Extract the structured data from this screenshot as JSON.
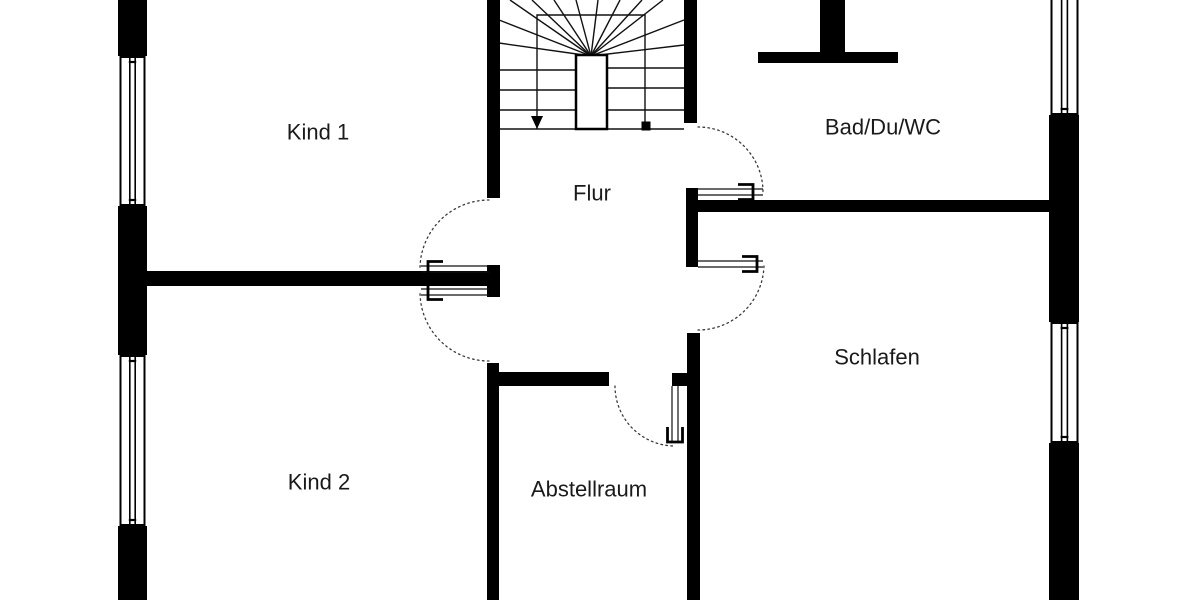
{
  "canvas": {
    "width": 1200,
    "height": 600,
    "background": "#ffffff",
    "wall_color": "#000000",
    "line_color": "#111111",
    "arc_color": "#3a3a3a",
    "label_color": "#1a1a1a",
    "label_font_size": 22
  },
  "rooms": [
    {
      "id": "kind1",
      "label": "Kind 1",
      "cx": 318,
      "cy": 132
    },
    {
      "id": "kind2",
      "label": "Kind 2",
      "cx": 319,
      "cy": 482
    },
    {
      "id": "flur",
      "label": "Flur",
      "cx": 592,
      "cy": 193
    },
    {
      "id": "bad",
      "label": "Bad/Du/WC",
      "cx": 883,
      "cy": 127
    },
    {
      "id": "schlafen",
      "label": "Schlafen",
      "cx": 877,
      "cy": 357
    },
    {
      "id": "abstellraum",
      "label": "Abstellraum",
      "cx": 589,
      "cy": 489
    }
  ],
  "walls": [
    {
      "id": "exterior-left-top",
      "x": 118,
      "y": 0,
      "w": 29,
      "h": 56
    },
    {
      "id": "exterior-left-mid",
      "x": 118,
      "y": 206,
      "w": 29,
      "h": 149
    },
    {
      "id": "exterior-left-bottom",
      "x": 118,
      "y": 526,
      "w": 29,
      "h": 74
    },
    {
      "id": "exterior-right-upper",
      "x": 1049,
      "y": 115,
      "w": 30,
      "h": 207
    },
    {
      "id": "exterior-right-lower",
      "x": 1049,
      "y": 443,
      "w": 30,
      "h": 157
    },
    {
      "id": "stair-left",
      "x": 487,
      "y": 0,
      "w": 13,
      "h": 198
    },
    {
      "id": "stair-right",
      "x": 684,
      "y": 0,
      "w": 13,
      "h": 123
    },
    {
      "id": "bad-south",
      "x": 697,
      "y": 200,
      "w": 352,
      "h": 12
    },
    {
      "id": "flur-east-stub",
      "x": 686,
      "y": 188,
      "w": 12,
      "h": 79
    },
    {
      "id": "schlafen-west",
      "x": 687,
      "y": 333,
      "w": 13,
      "h": 267
    },
    {
      "id": "kind-divider",
      "x": 147,
      "y": 271,
      "w": 340,
      "h": 15
    },
    {
      "id": "kind-door-stub",
      "x": 487,
      "y": 265,
      "w": 13,
      "h": 32
    },
    {
      "id": "abstellraum-west",
      "x": 487,
      "y": 363,
      "w": 12,
      "h": 237
    },
    {
      "id": "abstellraum-north",
      "x": 490,
      "y": 372,
      "w": 119,
      "h": 14
    },
    {
      "id": "abstellraum-north-stub",
      "x": 672,
      "y": 373,
      "w": 28,
      "h": 13
    },
    {
      "id": "chimney-block",
      "x": 820,
      "y": 0,
      "w": 25,
      "h": 63
    },
    {
      "id": "chimney-flange",
      "x": 758,
      "y": 52,
      "w": 140,
      "h": 11
    }
  ],
  "windows": [
    {
      "id": "kind1-west",
      "x": 119,
      "y": 56,
      "w": 27,
      "h": 150
    },
    {
      "id": "kind2-west",
      "x": 119,
      "y": 355,
      "w": 27,
      "h": 171
    },
    {
      "id": "bad-east",
      "x": 1050,
      "y": 0,
      "w": 29,
      "h": 115
    },
    {
      "id": "schlafen-east",
      "x": 1050,
      "y": 322,
      "w": 29,
      "h": 121
    }
  ],
  "doors": [
    {
      "id": "door-kind1",
      "hinge": [
        489,
        269
      ],
      "open": [
        -1,
        0
      ],
      "closed": [
        0,
        -1
      ],
      "r": 69,
      "leaf": 68,
      "bracket": [
        46,
        61
      ]
    },
    {
      "id": "door-kind2",
      "hinge": [
        489,
        292
      ],
      "open": [
        -1,
        0
      ],
      "closed": [
        0,
        1
      ],
      "r": 69,
      "leaf": 68,
      "bracket": [
        46,
        61
      ]
    },
    {
      "id": "door-bad",
      "hinge": [
        698,
        192
      ],
      "open": [
        1,
        0
      ],
      "closed": [
        0,
        -1
      ],
      "r": 65,
      "leaf": 65,
      "bracket": [
        40,
        55
      ]
    },
    {
      "id": "door-schlafen",
      "hinge": [
        698,
        264
      ],
      "open": [
        1,
        0
      ],
      "closed": [
        0,
        1
      ],
      "r": 66,
      "leaf": 65,
      "bracket": [
        44,
        59
      ]
    },
    {
      "id": "door-abstellraum",
      "hinge": [
        675,
        386
      ],
      "open": [
        0,
        1
      ],
      "closed": [
        -1,
        0
      ],
      "r": 60,
      "leaf": 57,
      "bracket": [
        41,
        56
      ]
    }
  ],
  "stair": {
    "x1": 499,
    "x2": 684,
    "y_bottom": 129,
    "inner": {
      "x1": 537,
      "x2": 645,
      "y1": 15
    },
    "newel": {
      "x": 576,
      "y": 55,
      "w": 31,
      "h": 74
    },
    "fan_center": [
      591,
      56
    ],
    "fan_targets": [
      [
        510,
        0
      ],
      [
        532,
        0
      ],
      [
        554,
        0
      ],
      [
        576,
        0
      ],
      [
        598,
        0
      ],
      [
        620,
        0
      ],
      [
        642,
        0
      ],
      [
        663,
        0
      ],
      [
        684,
        20
      ],
      [
        684,
        45
      ],
      [
        499,
        20
      ],
      [
        499,
        43
      ]
    ],
    "left_treads": [
      70,
      90,
      110
    ],
    "right_treads": [
      68,
      88,
      110
    ],
    "arrow": {
      "x": 537,
      "y": 129
    },
    "square": {
      "x": 646,
      "y": 126
    }
  }
}
